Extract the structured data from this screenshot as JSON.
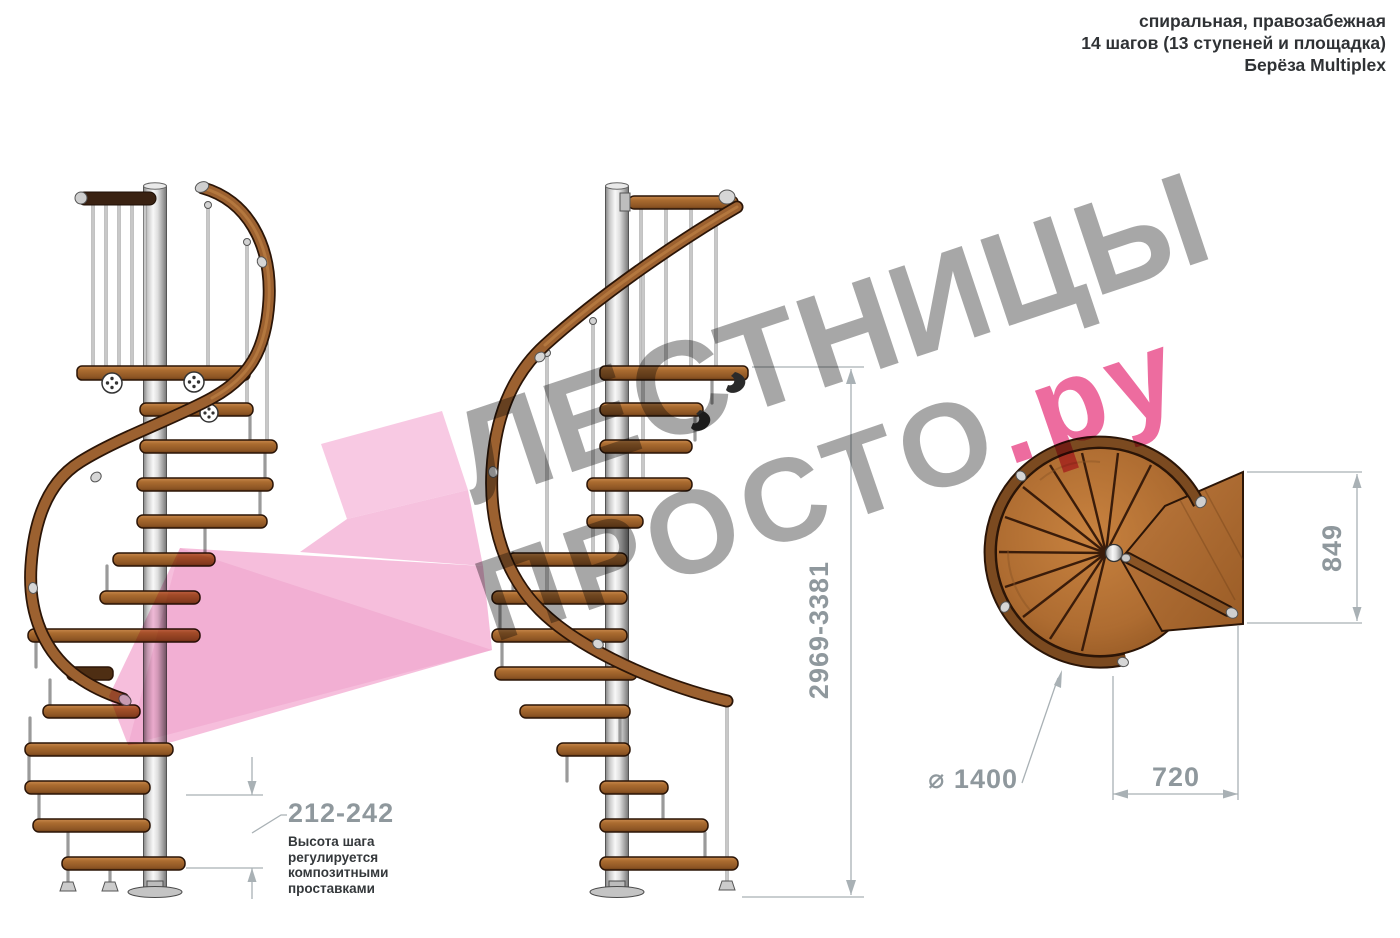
{
  "title_block": {
    "line1": "спиральная, правозабежная",
    "line2": "14 шагов (13 ступеней и площадка)",
    "line3": "Берёза Multiplex"
  },
  "watermark": {
    "word1": "ЛЕСТНИЦЫ",
    "word2": "ПРОСТО",
    "word2_suffix": ".ру",
    "gray_color": "#a0a0a0",
    "pink_color": "#ec5f97"
  },
  "annotations": {
    "total_height": "2969-3381",
    "step_height": "212-242",
    "step_height_note": "Высота шага регулируется композитными проставками",
    "diameter": "⌀ 1400",
    "landing_width": "720",
    "landing_depth": "849"
  },
  "legend": {
    "views": [
      "side view A",
      "side view B",
      "top view plan"
    ]
  },
  "colors": {
    "wood": "#a5682e",
    "wood_dark": "#7a4a1e",
    "wood_outline": "#2b1507",
    "metal_pole": "#d9d9d9",
    "dimension_gray": "#8f989d",
    "pink_arrow": "#f4b3d6"
  }
}
